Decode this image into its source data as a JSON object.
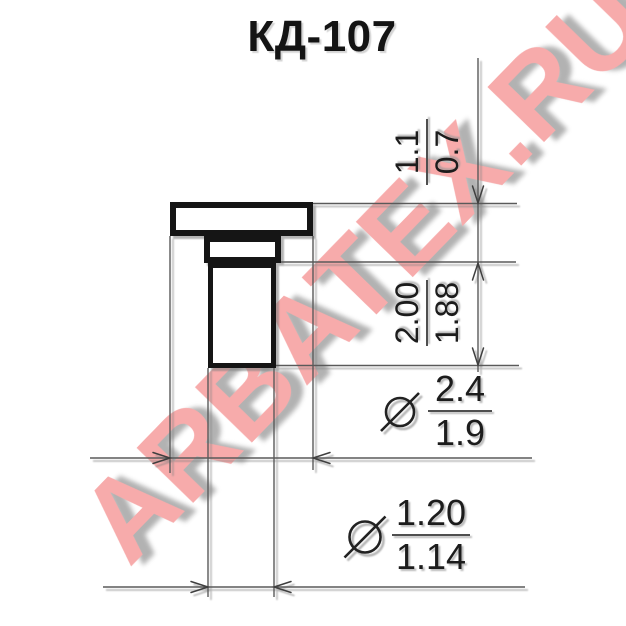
{
  "title": "КД-107",
  "watermark": {
    "text": "ARBATEX.RU",
    "color": "#f7abab"
  },
  "dimensions": {
    "flange_height": {
      "max": "1.1",
      "min": "0.7"
    },
    "case_height": {
      "max": "2.00",
      "min": "1.88"
    },
    "flange_diameter": {
      "max": "2.4",
      "min": "1.9"
    },
    "lead_diameter": {
      "max": "1.20",
      "min": "1.14"
    }
  }
}
